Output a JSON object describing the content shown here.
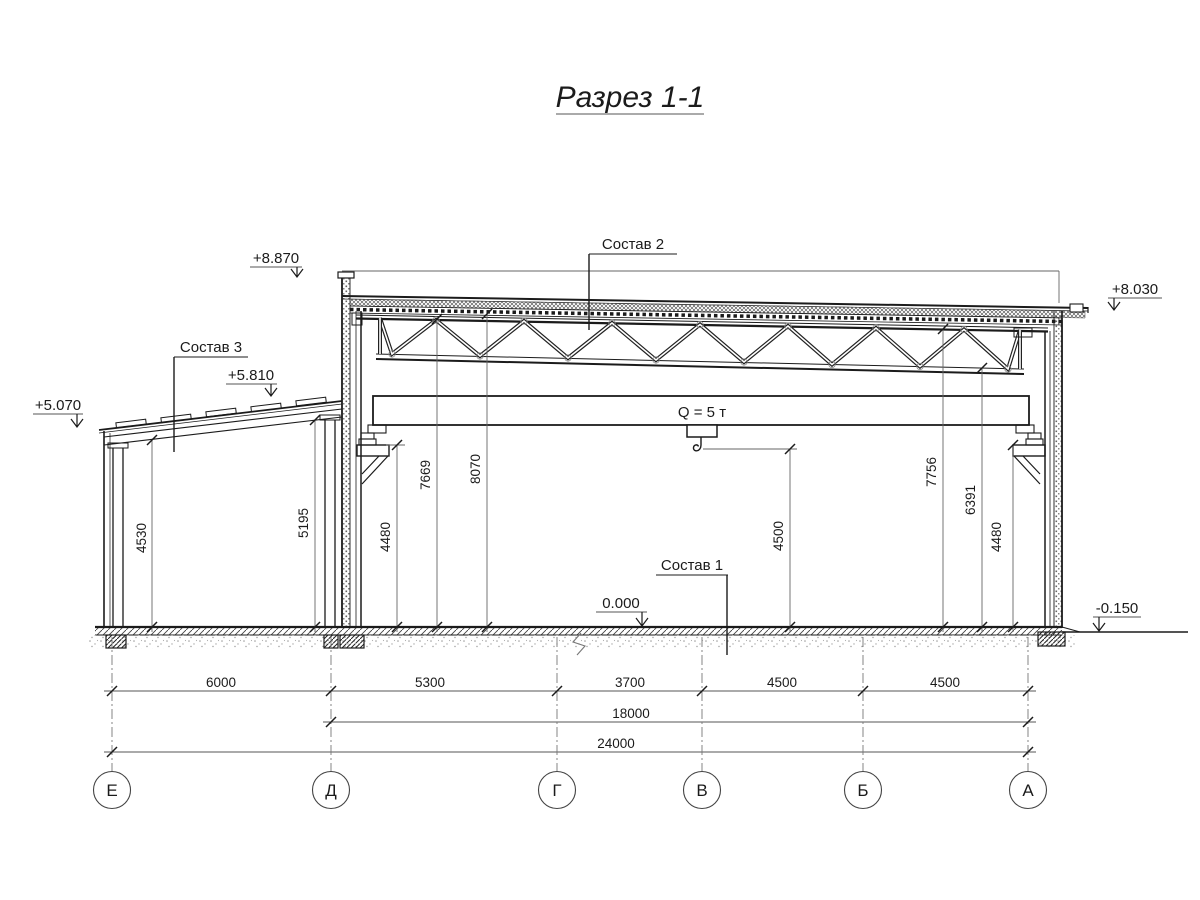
{
  "title": "Разрез 1-1",
  "labels": {
    "sostav1": "Состав 1",
    "sostav2": "Состав 2",
    "sostav3": "Состав 3",
    "crane_load": "Q = 5 т"
  },
  "elevations": {
    "parapet_left": "+8.870",
    "roof_right": "+8.030",
    "annex_high": "+5.810",
    "annex_low": "+5.070",
    "floor": "0.000",
    "ground": "-0.150"
  },
  "dimensions": {
    "horizontal": {
      "row1": [
        "6000",
        "5300",
        "3700",
        "4500",
        "4500"
      ],
      "row2": "18000",
      "row3": "24000"
    },
    "vertical": {
      "annex_left": "4530",
      "annex_right": "5195",
      "crane_rail_left": "4480",
      "truss_chord_left": "7669",
      "deck_left": "8070",
      "hook": "4500",
      "truss_chord_right": "7756",
      "truss_bottom_right": "6391",
      "crane_rail_right": "4480"
    }
  },
  "axes": [
    "Е",
    "Д",
    "Г",
    "В",
    "Б",
    "А"
  ]
}
